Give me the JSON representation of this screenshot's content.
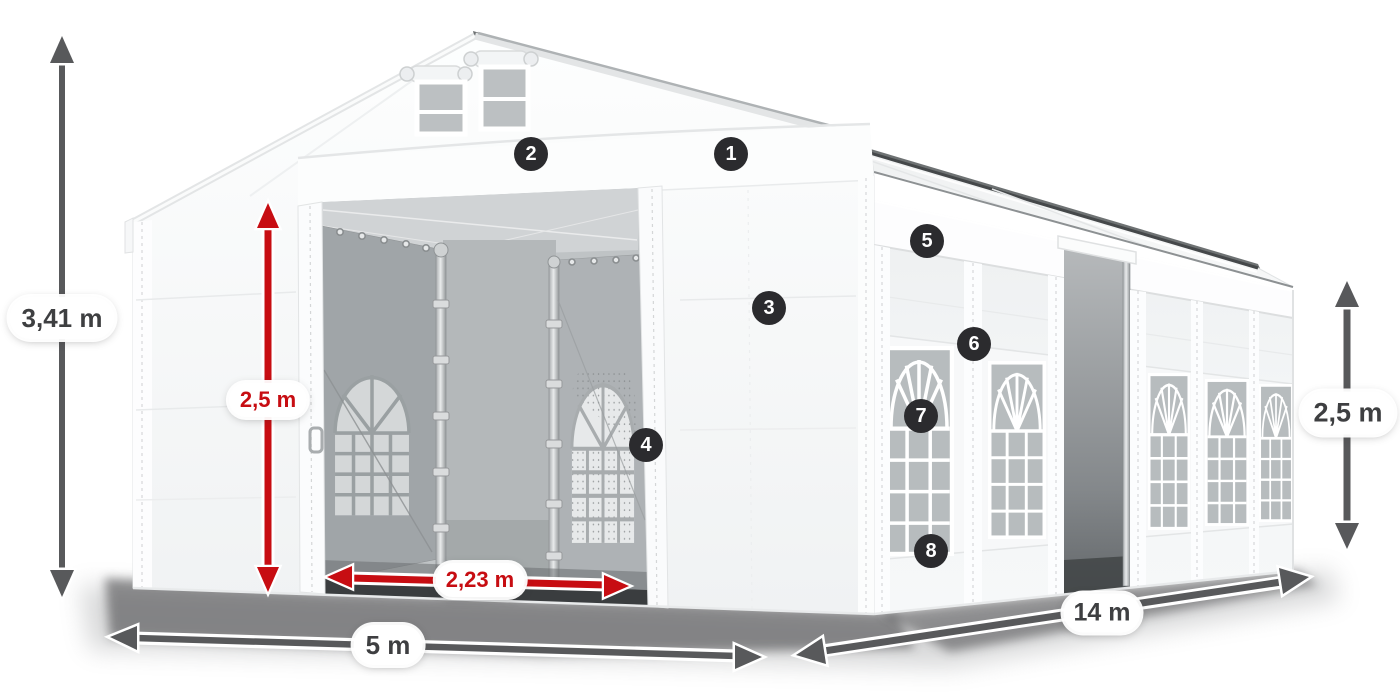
{
  "dimensions": {
    "total_height": {
      "label": "3,41 m"
    },
    "entrance_height": {
      "label": "2,5 m"
    },
    "entrance_width": {
      "label": "2,23 m"
    },
    "front_width": {
      "label": "5 m"
    },
    "side_length": {
      "label": "14 m"
    },
    "wall_height": {
      "label": "2,5 m"
    }
  },
  "badges": [
    "1",
    "2",
    "3",
    "4",
    "5",
    "6",
    "7",
    "8"
  ],
  "colors": {
    "dimension_red": "#c70d12",
    "dimension_gray": "#58595b",
    "badge_background": "#2b2b2e",
    "badge_text": "#ffffff",
    "label_text": "#3e3f41",
    "canvas_background": "#ffffff"
  }
}
